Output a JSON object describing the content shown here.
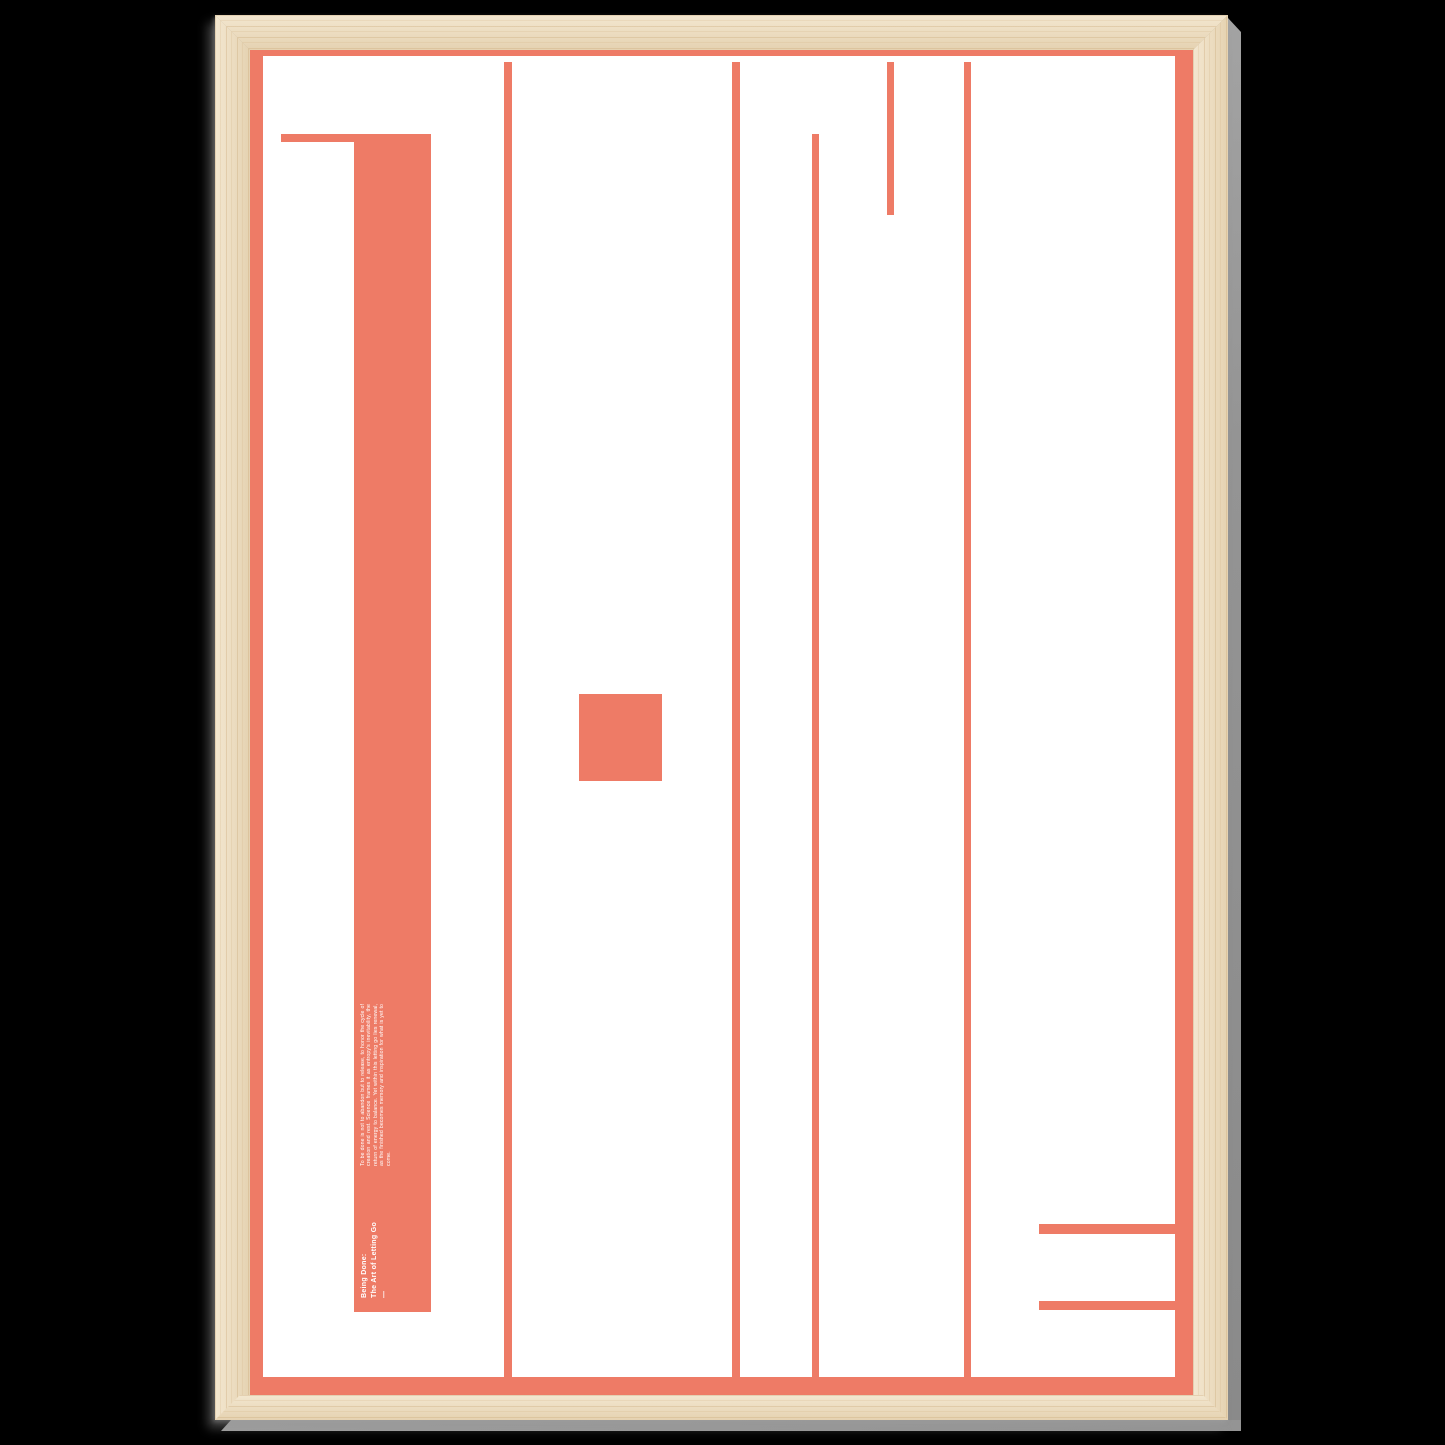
{
  "artwork": {
    "abstract_word": "DONE",
    "heading_line1": "Being Done:",
    "heading_line2": "The Art of Letting Go",
    "divider_dash": "—",
    "body_text": "To be done is not to abandon but to release, to honor the cycle of creation and rest. Science frames it as entropy's inevitability, the return of energy to balance. Yet within this letting go lies renewal, as the finished becomes memory and inspiration for what is yet to come."
  },
  "colors": {
    "coral": "#EE7B66",
    "paper_white": "#FFFFFF",
    "wood_light": "#F3E7D0",
    "wood_dark": "#E5D2B1",
    "wood_grain": "#C9A878",
    "edge_gray": "#949494",
    "background": "#000000",
    "text_white": "#FFFFFF"
  }
}
